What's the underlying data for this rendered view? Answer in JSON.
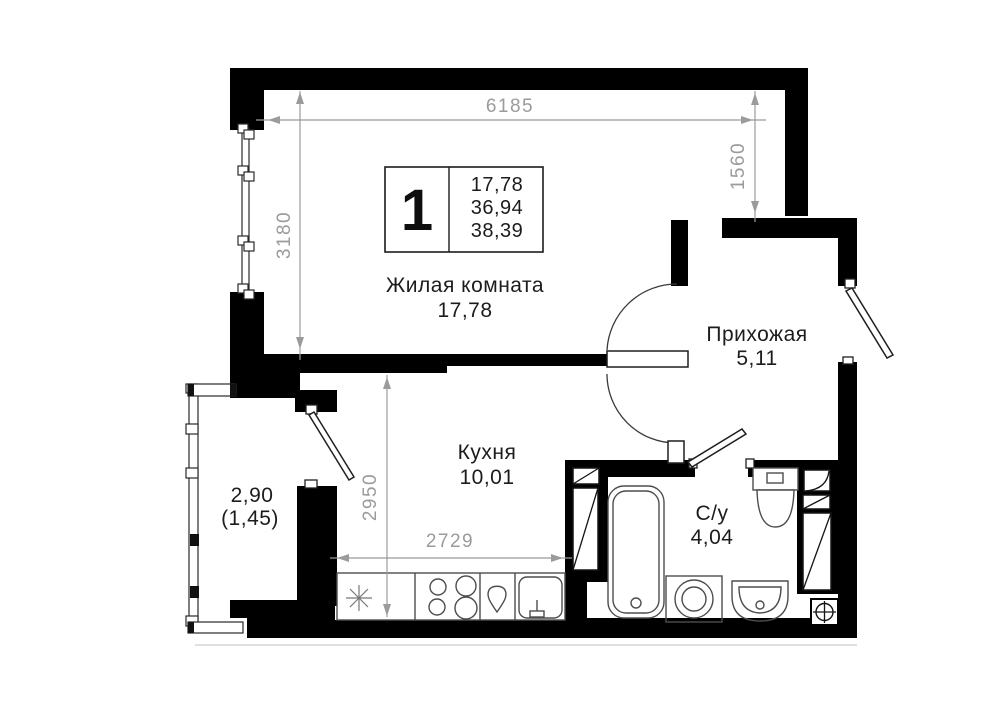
{
  "unit_info": {
    "room_count": "1",
    "area_lines": [
      "17,78",
      "36,94",
      "38,39"
    ]
  },
  "rooms": {
    "living": {
      "name": "Жилая комната",
      "area": "17,78"
    },
    "kitchen": {
      "name": "Кухня",
      "area": "10,01"
    },
    "hallway": {
      "name": "Прихожая",
      "area": "5,11"
    },
    "bathroom": {
      "name": "С/у",
      "area": "4,04"
    },
    "balcony": {
      "area": "2,90",
      "area_coefficient": "(1,45)"
    }
  },
  "dimensions": {
    "living_width": "6185",
    "niche_depth": "1560",
    "living_depth": "3180",
    "kitchen_depth": "2950",
    "kitchen_width": "2729"
  },
  "fixtures": [
    "bathtub",
    "toilet",
    "washbasin",
    "washing-machine",
    "stove",
    "kitchen-sink",
    "fridge-star",
    "ventilation-grille",
    "duct-shaft"
  ],
  "colors": {
    "wall": "#000000",
    "dimension": "#9b9b9b",
    "fixture_stroke": "#4d4d4d",
    "label": "#1c1c1c",
    "background": "#ffffff"
  }
}
